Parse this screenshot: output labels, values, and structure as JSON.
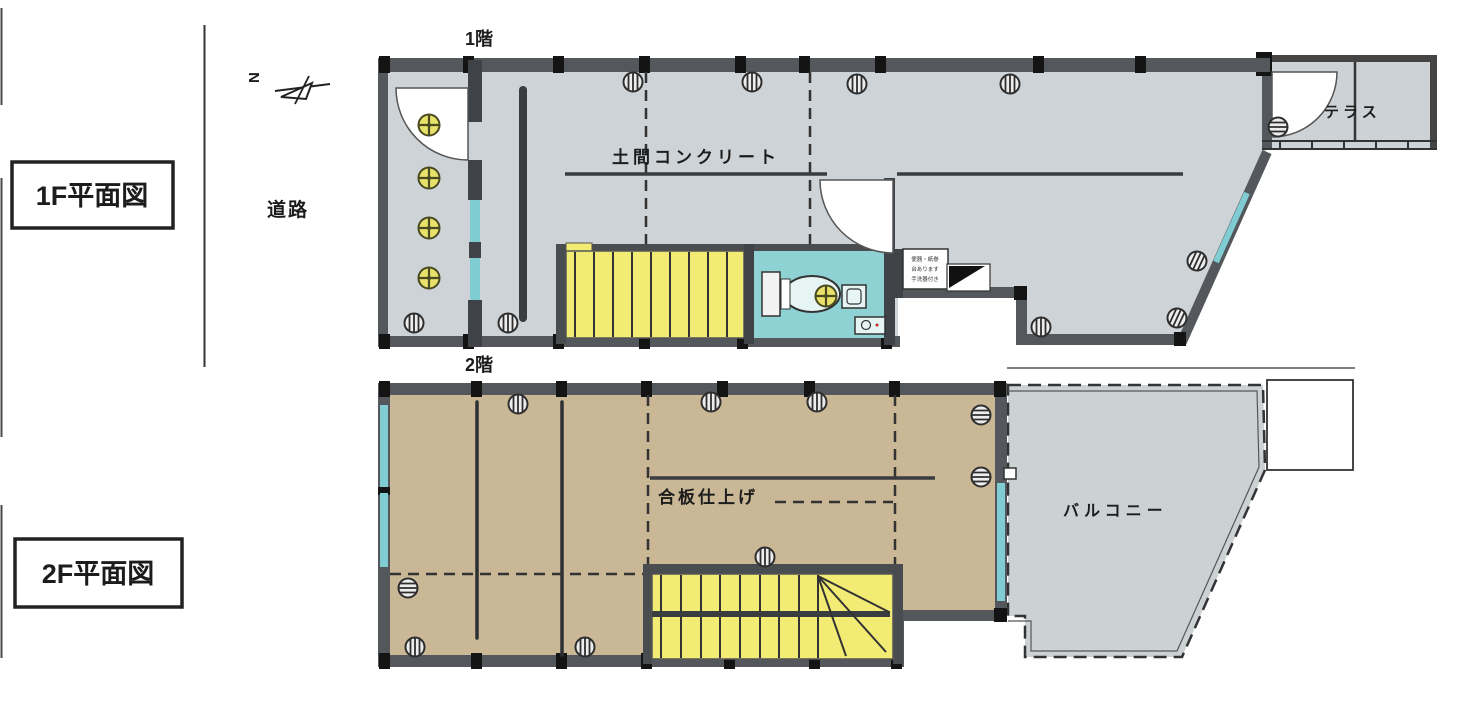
{
  "page": {
    "title_1f_box": "1F平面図",
    "title_2f_box": "2F平面図",
    "road_label": "道路",
    "north_label": "N"
  },
  "plan1f": {
    "floor_tag": "1階",
    "surface_label": "土間コンクリート",
    "terrace_label": "テラス",
    "note_lines": [
      "便器・紙巻",
      "台あります",
      "手洗器付き"
    ]
  },
  "plan2f": {
    "floor_tag": "2階",
    "surface_label": "合板仕上げ",
    "balcony_label": "バルコニー"
  },
  "colors": {
    "floor_gray": "#cdd3d6",
    "floor_tan": "#c9b795",
    "stair_yellow": "#f2ec74",
    "water_cyan": "#8fd2d4",
    "glass_cyan": "#7fcdd3",
    "wall_dark": "#54575b",
    "column_black": "#141414",
    "line_dark": "#333333",
    "accent_red": "#c03030"
  }
}
